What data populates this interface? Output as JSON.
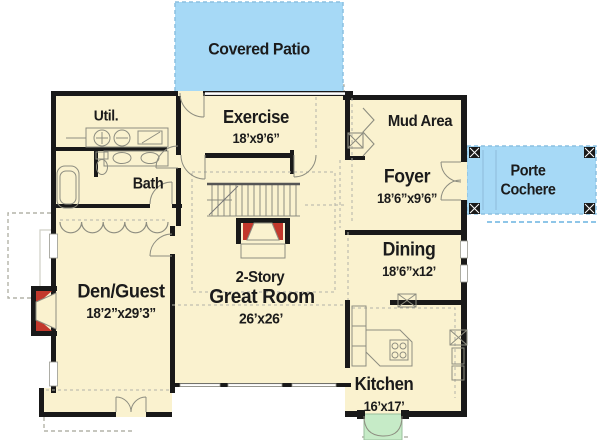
{
  "palette": {
    "cream": "#FAF2CF",
    "blue": "#A6D9F6",
    "green": "#C6EBC7",
    "red": "#C2382C",
    "wall": "#191919",
    "line": "#8D8D80",
    "dash": "#B3B3A8",
    "window": "#FFFFFF",
    "text": "#1B1B1B"
  },
  "rooms": {
    "covered_patio": {
      "label": "Covered Patio"
    },
    "util": {
      "label": "Util."
    },
    "exercise": {
      "label": "Exercise",
      "dims": "18’x9’6”"
    },
    "mud_area": {
      "label": "Mud Area"
    },
    "bath": {
      "label": "Bath"
    },
    "foyer": {
      "label": "Foyer",
      "dims": "18’6”x9’6”"
    },
    "porte_cochere": {
      "line1": "Porte",
      "line2": "Cochere"
    },
    "dining": {
      "label": "Dining",
      "dims": "18’6”x12’"
    },
    "den_guest": {
      "label": "Den/Guest",
      "dims": "18’2”x29’3”"
    },
    "great_room": {
      "line1": "2-Story",
      "line2": "Great Room",
      "dims": "26’x26’"
    },
    "kitchen": {
      "label": "Kitchen",
      "dims": "16’x17’"
    }
  }
}
